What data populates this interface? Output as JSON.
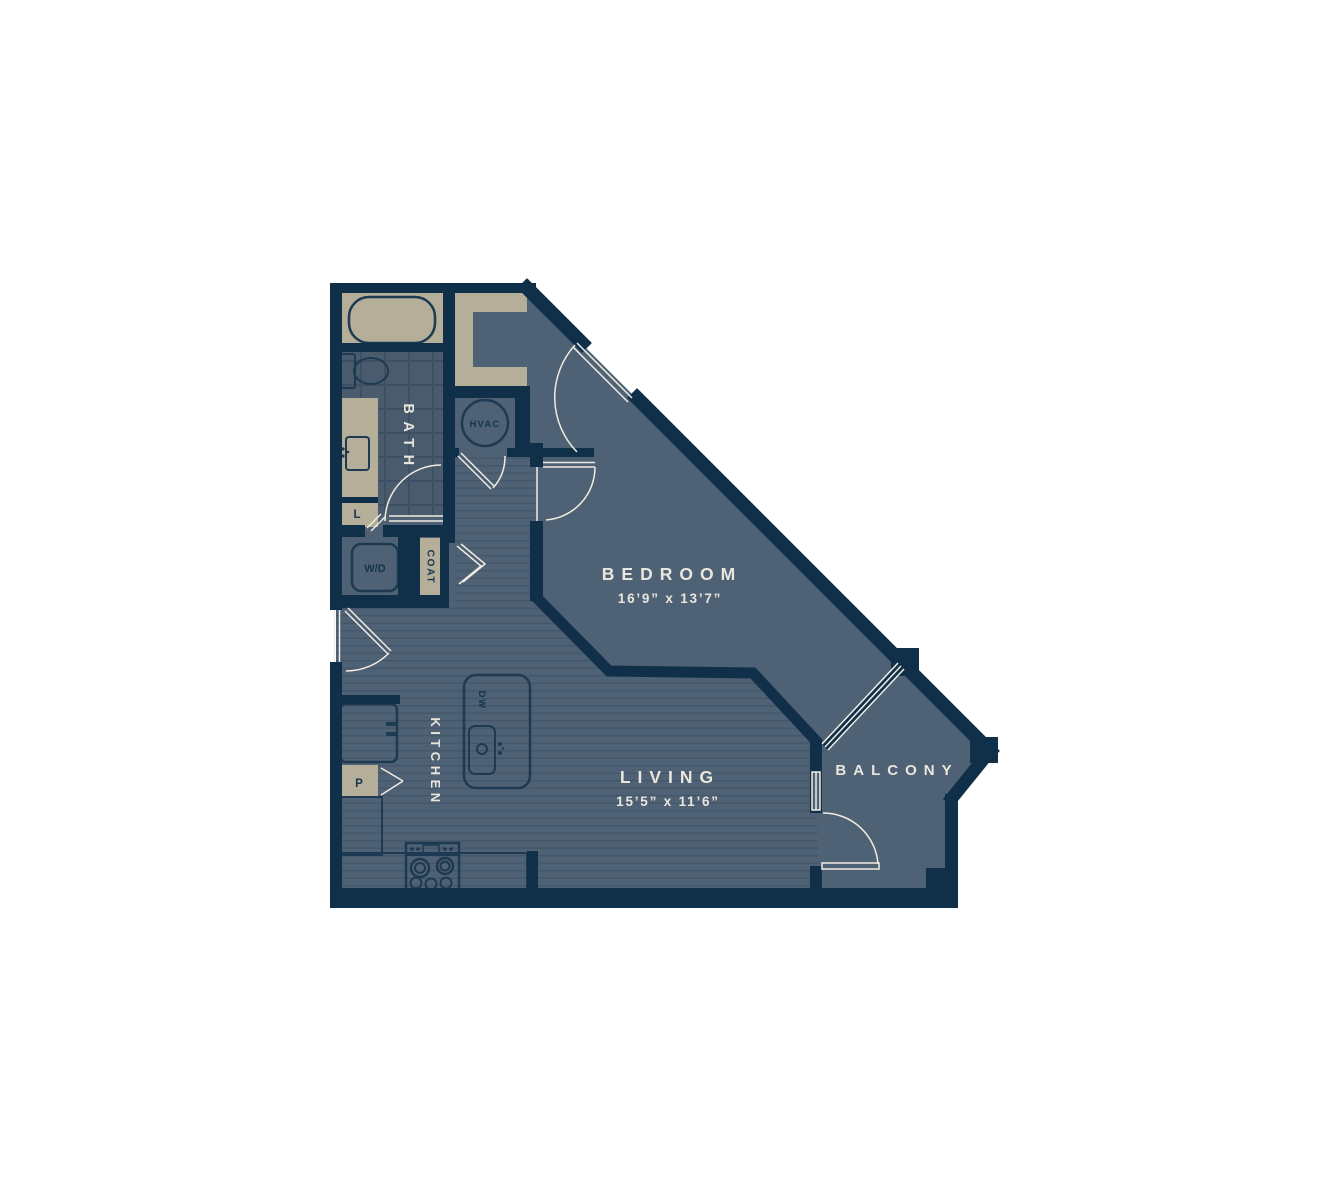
{
  "plan": {
    "title": "One-bedroom apartment floor plan",
    "rooms": {
      "bedroom": {
        "label": "BEDROOM",
        "dimensions": "16’9” x 13’7”"
      },
      "living": {
        "label": "LIVING",
        "dimensions": "15’5” x 11’6”"
      },
      "balcony": {
        "label": "BALCONY"
      },
      "bath": {
        "label": "BATH"
      },
      "kitchen": {
        "label": "KITCHEN"
      }
    },
    "closets": {
      "hvac": "HVAC",
      "washer_dryer": "W/D",
      "coat": "COAT",
      "linen": "L",
      "pantry": "P",
      "dishwasher": "DW"
    },
    "colors": {
      "wall": "#10304a",
      "floor": "#4f6174",
      "floor_stripe": "#445669",
      "tile": "#4a5b6e",
      "tile_line": "#3d5064",
      "fixture": "#b5ae99",
      "fixture_outline": "#1d3a52",
      "line_white": "#f0ece1",
      "text_light": "#e9e6dd",
      "text_dark": "#16354e",
      "background": "#ffffff"
    }
  }
}
